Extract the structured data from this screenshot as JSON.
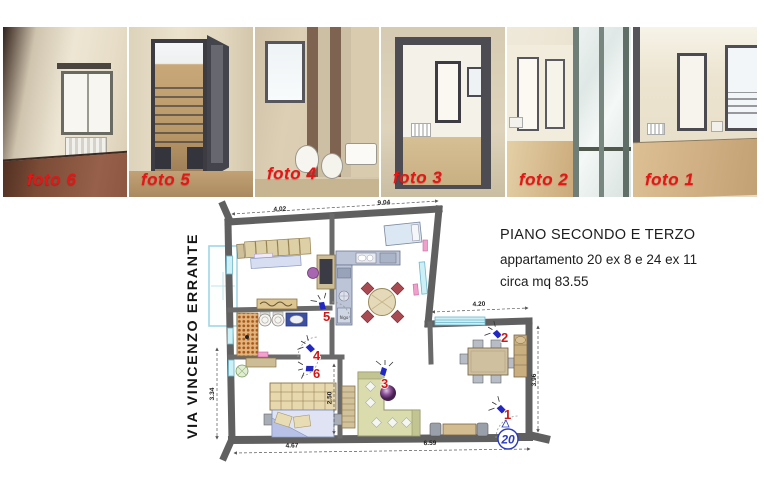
{
  "photos": [
    {
      "label": "foto 6"
    },
    {
      "label": "foto 5"
    },
    {
      "label": "foto 4"
    },
    {
      "label": "foto 3"
    },
    {
      "label": "foto 2"
    },
    {
      "label": "foto 1"
    }
  ],
  "info": {
    "title": "PIANO SECONDO  E TERZO",
    "apartment": "appartamento  20 ex 8 e 24 ex 11",
    "area": "circa mq 83.55"
  },
  "plan": {
    "street": "VIA VINCENZO ERRANTE",
    "unit_number": "20",
    "appliance_label": "frigo",
    "markers": [
      "1",
      "2",
      "3",
      "4",
      "5",
      "6"
    ],
    "dimensions": {
      "top_left": "4.02",
      "top_right": "9.04",
      "right_window": "4.20",
      "right_side": "3.96",
      "bottom_left": "4.67",
      "bottom_right": "6.59",
      "left_side": "3.34",
      "bedroom": "2.50"
    }
  },
  "colors": {
    "label_red": "#e41616",
    "marker_red": "#d01818",
    "camera_blue": "#2228c0",
    "unit_blue": "#2a3bc0",
    "wall_gray": "#606060",
    "window_cyan": "#cdeff6"
  }
}
